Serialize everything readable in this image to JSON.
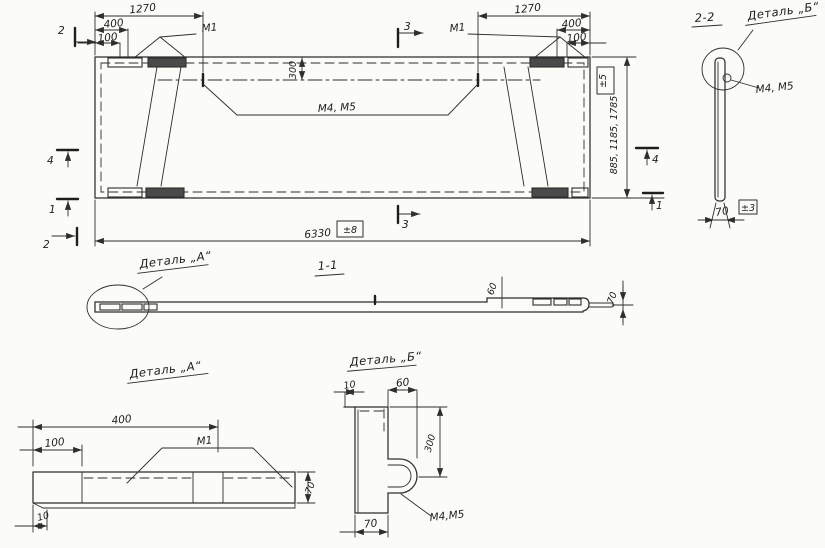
{
  "drawing": {
    "plan": {
      "dim_1270_left": "1270",
      "dim_400_left": "400",
      "dim_100_left": "100",
      "dim_1270_right": "1270",
      "dim_400_right": "400",
      "dim_100_right": "100",
      "weld_m1_left": "М1",
      "weld_m1_right": "М1",
      "dim_300": "300",
      "weld_m4_m5": "М4, М5",
      "dim_length": "6330",
      "tol_length": "±8",
      "dim_heights": "885, 1185, 1785",
      "tol_heights": "±5",
      "marker_2_top": "2",
      "marker_4_left": "4",
      "marker_1_left": "1",
      "marker_2_bottom": "2",
      "marker_3_top": "3",
      "marker_3_bottom": "3",
      "marker_4_right": "4",
      "marker_1_right": "1"
    },
    "s22": {
      "title": "2-2",
      "detail_label": "Деталь „Б“",
      "weld_label": "М4, М5",
      "dim_width": "70",
      "tol_width": "±3"
    },
    "s11": {
      "title": "1-1",
      "detail_label": "Деталь „А“",
      "dim_60": "60",
      "dim_70": "70"
    },
    "da": {
      "title": "Деталь „А“",
      "dim_400": "400",
      "dim_100": "100",
      "weld_m1": "М1",
      "dim_70": "70",
      "dim_10": "10"
    },
    "db": {
      "title": "Деталь „Б“",
      "dim_10": "10",
      "dim_60": "60",
      "dim_300": "300",
      "dim_70": "70",
      "weld_label": "М4,М5"
    }
  }
}
